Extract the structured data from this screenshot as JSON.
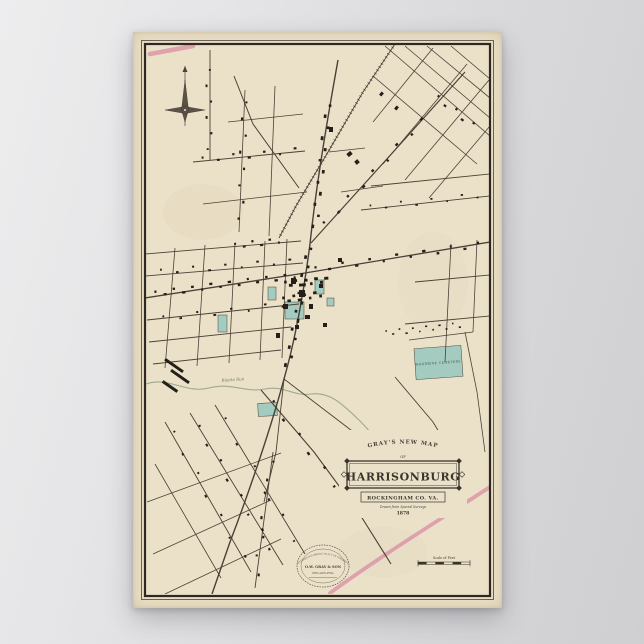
{
  "background": {
    "left_tint": "#ededee",
    "right_tint": "#cfcfd2"
  },
  "poster": {
    "paper_color": "#ebe1c9",
    "frame_color": "#332c24",
    "title_cartouche": {
      "arch_text": "GRAY'S NEW MAP",
      "of_text": "OF",
      "title": "HARRISONBURG",
      "subtitle": "ROCKINGHAM CO. VA.",
      "note": "Drawn from Special Surveys",
      "year": "1878"
    },
    "labels": {
      "cemetery": "WOODBINE CEMETERY",
      "creek": "Blacks Run"
    },
    "publisher_emblem": {
      "top": "ENTERED ACCORDING TO ACT OF CONGRESS",
      "name": "O.W. GRAY & SON",
      "bottom": "PHILADELPHIA"
    },
    "scale_bar": {
      "label": "Scale of Feet"
    },
    "map_art": {
      "ink": "#4a4136",
      "building_ink": "#241f19",
      "green": "#a3cbbf",
      "pink": "#dc97a6",
      "creek_color": "#98a38b",
      "streets": [
        {
          "d": "M205,28 C193,95 183,155 177,212 C171,258 163,305 151,347 C139,392 118,455 97,510 C90,530 84,548 79,562",
          "w": 1.4
        },
        {
          "d": "M172,241 L357,210",
          "w": 1.3
        },
        {
          "d": "M172,241 L12,266",
          "w": 1.3
        },
        {
          "d": "M178,211 L262,118 L332,40",
          "w": 1.2
        },
        {
          "d": "M166,156 L120,92 L101,44",
          "w": 1
        },
        {
          "d": "M128,358 L181,420 L226,481 L258,532",
          "w": 1.1
        },
        {
          "d": "M151,347 L210,392 L240,415",
          "w": 0.9
        },
        {
          "d": "M151,347 L143,420 L131,470",
          "w": 0.9
        },
        {
          "d": "M252,14 L357,104",
          "w": 0.8
        },
        {
          "d": "M272,14 L357,86",
          "w": 0.8
        },
        {
          "d": "M294,14 L357,66",
          "w": 0.8
        },
        {
          "d": "M318,14 L357,47",
          "w": 0.8
        },
        {
          "d": "M240,44 L344,132",
          "w": 0.8
        },
        {
          "d": "M250,132 L334,32",
          "w": 0.8
        },
        {
          "d": "M272,148 L356,48",
          "w": 0.8
        },
        {
          "d": "M240,90 L300,16",
          "w": 0.8
        },
        {
          "d": "M296,166 L357,94",
          "w": 0.8
        },
        {
          "d": "M238,154 L357,142",
          "w": 0.9
        },
        {
          "d": "M228,178 L357,164",
          "w": 0.9
        },
        {
          "d": "M282,250 L357,243",
          "w": 0.9
        },
        {
          "d": "M272,292 L357,284",
          "w": 0.9
        },
        {
          "d": "M318,212 L312,330",
          "w": 0.8
        },
        {
          "d": "M344,208 L340,300",
          "w": 0.8
        },
        {
          "d": "M12,222 L168,209",
          "w": 0.9
        },
        {
          "d": "M12,244 L170,231",
          "w": 0.9
        },
        {
          "d": "M14,288 L166,272",
          "w": 0.9
        },
        {
          "d": "M16,310 L158,295",
          "w": 0.9
        },
        {
          "d": "M20,332 L148,318",
          "w": 0.9
        },
        {
          "d": "M42,216 L32,336",
          "w": 0.8
        },
        {
          "d": "M72,213 L64,334",
          "w": 0.8
        },
        {
          "d": "M102,211 L96,331",
          "w": 0.8
        },
        {
          "d": "M132,209 L127,328",
          "w": 0.8
        },
        {
          "d": "M154,207 L149,326",
          "w": 0.8
        },
        {
          "d": "M77,18 L77,128",
          "w": 0.9
        },
        {
          "d": "M112,58 L106,200",
          "w": 0.8
        },
        {
          "d": "M142,54 L136,204",
          "w": 0.8
        },
        {
          "d": "M60,130 L172,119",
          "w": 0.9
        },
        {
          "d": "M70,172 L174,160",
          "w": 0.8
        },
        {
          "d": "M95,90 L170,82",
          "w": 0.8
        },
        {
          "d": "M32,390 L118,540",
          "w": 0.9
        },
        {
          "d": "M57,381 L150,533",
          "w": 0.9
        },
        {
          "d": "M82,373 L172,522",
          "w": 0.9
        },
        {
          "d": "M22,432 L88,546",
          "w": 0.8
        },
        {
          "d": "M14,470 L148,421",
          "w": 0.8
        },
        {
          "d": "M20,522 L138,468",
          "w": 0.8
        },
        {
          "d": "M32,562 L148,507",
          "w": 0.8
        },
        {
          "d": "M276,308 L340,300",
          "w": 0.8
        },
        {
          "d": "M262,345 L300,390 L330,440",
          "w": 0.9
        },
        {
          "d": "M332,300 L344,360 L352,420",
          "w": 0.8
        },
        {
          "d": "M196,120 L232,116",
          "w": 0.7
        },
        {
          "d": "M208,160 L250,154",
          "w": 0.7
        },
        {
          "d": "M140,420 L122,556",
          "w": 0.9
        }
      ],
      "railroad": {
        "d": "M262,12 L230,60 L195,120 L163,174 L146,206",
        "w": 0.9
      },
      "creek": {
        "d": "M13,352 C36,344 52,362 76,356 C98,350 112,361 132,357 C150,353 162,365 178,362 C198,359 212,375 226,388 C240,402 252,418 264,434 C272,445 278,452 284,460",
        "w": 1.1
      },
      "pink_roads": [
        {
          "d": "M17,22 L60,14",
          "w": 4.5
        },
        {
          "d": "M197,561 C252,521 310,486 366,449",
          "w": 3.8
        }
      ],
      "green_blocks": [
        [
          135,
          255,
          8,
          13,
          0
        ],
        [
          152,
          270,
          19,
          17,
          0
        ],
        [
          182,
          248,
          9,
          14,
          0
        ],
        [
          194,
          266,
          7,
          8,
          0
        ],
        [
          85,
          283,
          9,
          17,
          0
        ],
        [
          125,
          371,
          19,
          13,
          -3
        ],
        [
          282,
          315,
          47,
          31,
          -4
        ]
      ],
      "building_rows": [
        [
          196,
          68,
          181,
          200,
          12,
          3
        ],
        [
          177,
          212,
          154,
          338,
          14,
          3
        ],
        [
          18,
          262,
          166,
          243,
          16,
          2.6
        ],
        [
          176,
          238,
          352,
          212,
          13,
          2.6
        ],
        [
          62,
          128,
          170,
          118,
          7,
          2.4
        ],
        [
          20,
          240,
          165,
          229,
          9,
          2.2
        ],
        [
          22,
          287,
          158,
          272,
          8,
          2.2
        ],
        [
          186,
          198,
          296,
          82,
          9,
          2.6
        ],
        [
          133,
          362,
          222,
          478,
          7,
          2.6
        ],
        [
          60,
          386,
          143,
          525,
          8,
          2.4
        ],
        [
          250,
          301,
          330,
          293,
          12,
          1.8
        ],
        [
          300,
          62,
          344,
          96,
          5,
          2.4
        ],
        [
          150,
          252,
          196,
          248,
          9,
          3.2
        ],
        [
          148,
          268,
          190,
          262,
          8,
          3
        ],
        [
          98,
          214,
          150,
          208,
          6,
          2.4
        ],
        [
          112,
          62,
          107,
          195,
          8,
          2.4
        ],
        [
          140,
          420,
          122,
          552,
          7,
          2.4
        ],
        [
          230,
          176,
          352,
          163,
          8,
          2
        ],
        [
          75,
          30,
          77,
          125,
          6,
          2.2
        ],
        [
          34,
          390,
          116,
          536,
          7,
          2.2
        ],
        [
          84,
          375,
          170,
          520,
          6,
          2.2
        ]
      ],
      "buildings": [
        [
          158,
          246,
          5,
          6,
          0
        ],
        [
          166,
          258,
          6,
          7,
          0
        ],
        [
          150,
          272,
          5,
          5,
          0
        ],
        [
          176,
          272,
          4,
          5,
          0
        ],
        [
          186,
          252,
          4,
          4,
          0
        ],
        [
          172,
          283,
          5,
          4,
          0
        ],
        [
          162,
          293,
          4,
          4,
          0
        ],
        [
          143,
          301,
          4,
          5,
          0
        ],
        [
          190,
          291,
          4,
          4,
          0
        ],
        [
          205,
          226,
          4,
          4,
          0
        ],
        [
          30,
          332,
          22,
          3,
          35
        ],
        [
          36,
          343,
          22,
          3,
          35
        ],
        [
          28,
          353,
          18,
          3,
          35
        ],
        [
          214,
          120,
          5,
          4,
          -40
        ],
        [
          222,
          128,
          4,
          4,
          -40
        ],
        [
          196,
          95,
          4,
          5,
          0
        ],
        [
          247,
          60,
          3,
          4,
          40
        ],
        [
          262,
          74,
          3,
          4,
          40
        ]
      ]
    }
  }
}
